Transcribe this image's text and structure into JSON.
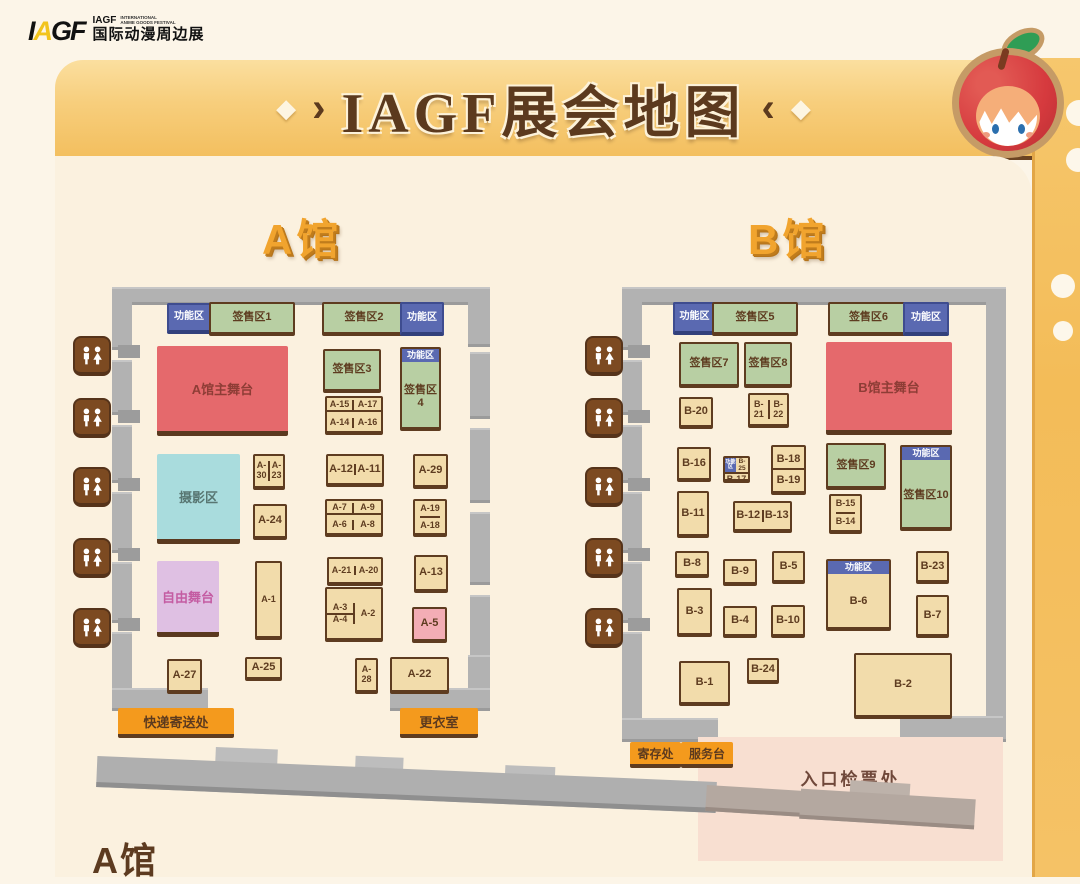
{
  "logo": {
    "mark_chars": [
      "I",
      "A",
      "G",
      "F"
    ],
    "name_en": "IAGF",
    "tagline_line1": "INTERNATIONAL",
    "tagline_line2": "ANIME GOODS FESTIVAL",
    "name_cn": "国际动漫周边展"
  },
  "title": "IAGF展会地图",
  "footer": {
    "hall_a_label": "A馆"
  },
  "hallA": {
    "title": "A馆",
    "func_label": "功能区",
    "stage": "A馆主舞台",
    "photo": "摄影区",
    "free_stage": "自由舞台",
    "sign": [
      "签售区1",
      "签售区2",
      "签售区3",
      "签售区4"
    ],
    "services": {
      "express": "快递寄送处",
      "changing": "更衣室"
    },
    "booths": {
      "a1": "A-1",
      "a2": "A-2",
      "a3": "A-3",
      "a4": "A-4",
      "a5": "A-5",
      "a6": "A-6",
      "a7": "A-7",
      "a8": "A-8",
      "a9": "A-9",
      "a11": "A-11",
      "a12": "A-12",
      "a13": "A-13",
      "a14": "A-14",
      "a15": "A-15",
      "a16": "A-16",
      "a17": "A-17",
      "a18": "A-18",
      "a19": "A-19",
      "a20": "A-20",
      "a21": "A-21",
      "a22": "A-22",
      "a23": "A-23",
      "a24": "A-24",
      "a25": "A-25",
      "a27": "A-27",
      "a28": "A-28",
      "a29": "A-29",
      "a30": "A-30"
    }
  },
  "hallB": {
    "title": "B馆",
    "func_label": "功能区",
    "stage": "B馆主舞台",
    "sign": [
      "签售区5",
      "签售区6",
      "签售区7",
      "签售区8",
      "签售区9",
      "签售区10"
    ],
    "services": {
      "storage": "寄存处",
      "service_desk": "服务台",
      "entrance": "入口检票处"
    },
    "booths": {
      "b1": "B-1",
      "b2": "B-2",
      "b3": "B-3",
      "b4": "B-4",
      "b5": "B-5",
      "b6": "B-6",
      "b7": "B-7",
      "b8": "B-8",
      "b9": "B-9",
      "b10": "B-10",
      "b11": "B-11",
      "b12": "B-12",
      "b13": "B-13",
      "b14": "B-14",
      "b15": "B-15",
      "b16": "B-16",
      "b17": "B-17",
      "b18": "B-18",
      "b19": "B-19",
      "b20": "B-20",
      "b21": "B-21",
      "b22": "B-22",
      "b23": "B-23",
      "b24": "B-24",
      "b25": "B-25"
    }
  },
  "colors": {
    "banner_gold": "#F7CE7C",
    "booth_tan": "#F2DCAB",
    "sign_green": "#B8CFA3",
    "func_blue": "#5A69B1",
    "stage_red": "#E5696C",
    "photo_cyan": "#A9DCDD",
    "free_purple": "#DFC0E3",
    "booth_pink": "#F3ADB5",
    "service_orange": "#F49A1D",
    "wall_gray": "#B2B2B2",
    "entrance_pink": "#F8DFD1",
    "text_brown": "#5E3C20"
  }
}
